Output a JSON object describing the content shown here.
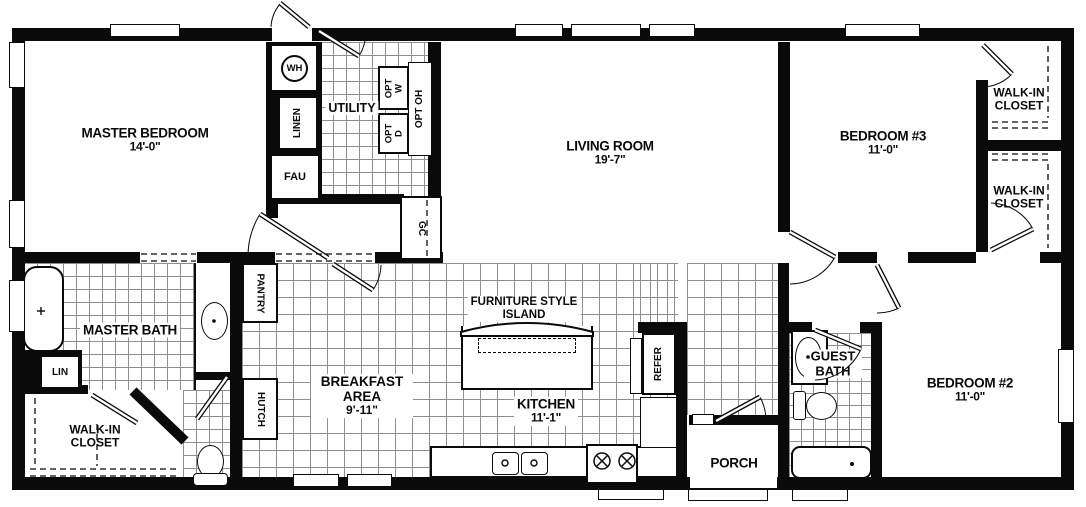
{
  "plan": {
    "title": "manufactured-home-floor-plan",
    "rooms": {
      "master_bedroom": {
        "name": "MASTER BEDROOM",
        "dim": "14'-0\""
      },
      "living_room": {
        "name": "LIVING ROOM",
        "dim": "19'-7\""
      },
      "bedroom3": {
        "name": "BEDROOM #3",
        "dim": "11'-0\""
      },
      "bedroom2": {
        "name": "BEDROOM #2",
        "dim": "11'-0\""
      },
      "breakfast_area": {
        "name": "BREAKFAST AREA",
        "dim": "9'-11\""
      },
      "kitchen": {
        "name": "KITCHEN",
        "dim": "11'-1\""
      },
      "master_bath": {
        "name": "MASTER BATH"
      },
      "guest_bath": {
        "name": "GUEST BATH"
      },
      "utility": {
        "name": "UTILITY"
      },
      "porch": {
        "name": "PORCH"
      },
      "walkin_closet_top": {
        "name": "WALK-IN CLOSET"
      },
      "walkin_closet_mid": {
        "name": "WALK-IN CLOSET"
      },
      "walkin_closet_master": {
        "name": "WALK-IN CLOSET"
      }
    },
    "fixtures": {
      "wh": "WH",
      "linen": "LINEN",
      "fau": "FAU",
      "gc": "GC",
      "opt_w_l1": "OPT",
      "opt_w_l2": "W",
      "opt_d_l1": "OPT",
      "opt_d_l2": "D",
      "opt_oh": "OPT OH",
      "pantry": "PANTRY",
      "hutch": "HUTCH",
      "lin": "LIN",
      "refer": "REFER",
      "island_l1": "FURNITURE STYLE",
      "island_l2": "ISLAND"
    },
    "colors": {
      "wall": "#0a0a0a",
      "tile_line": "#8f8f8f",
      "background": "#ffffff"
    }
  }
}
